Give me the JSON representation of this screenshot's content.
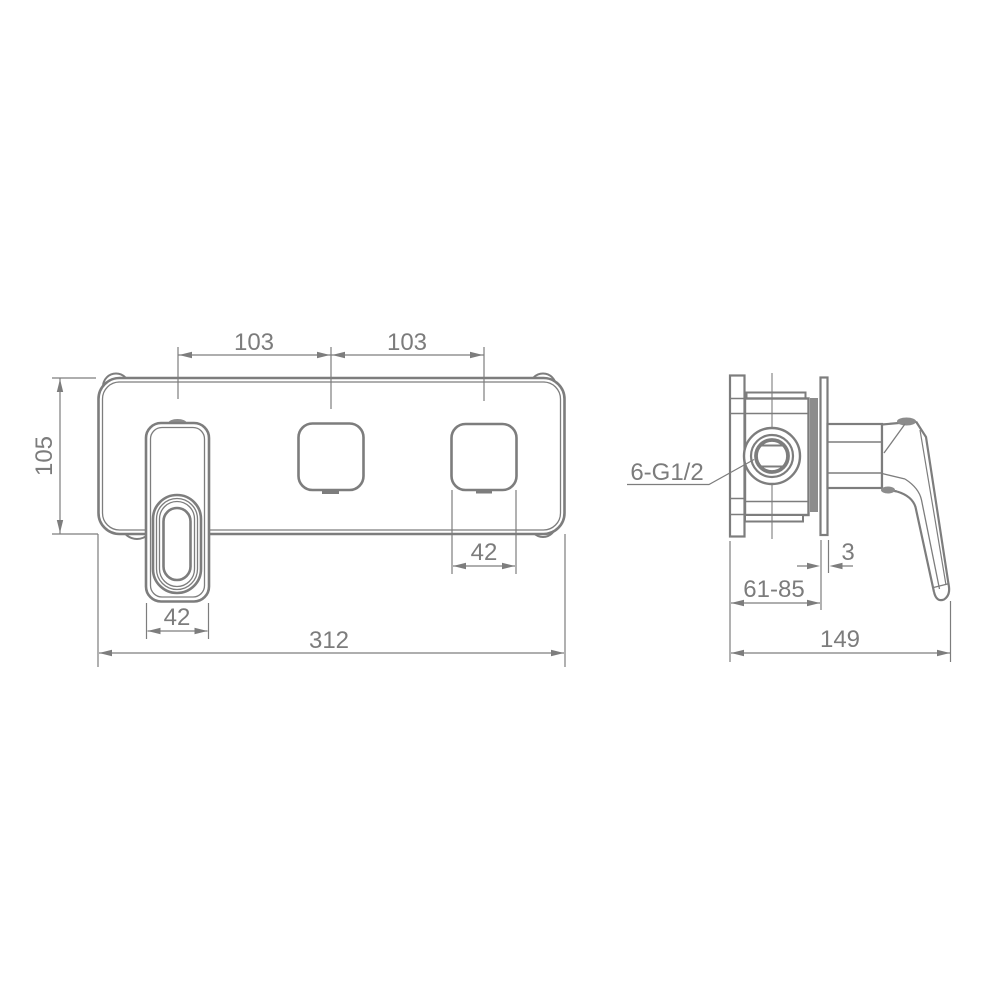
{
  "drawing": {
    "type": "technical-dimension-drawing",
    "subject": "wall-mounted-basin-mixer",
    "colors": {
      "line": "#7d7d7d",
      "text": "#7c7c7c",
      "shade_fill": "#8c8c8c",
      "background": "#ffffff"
    },
    "front_view": {
      "dims": {
        "spacing_left": "103",
        "spacing_right": "103",
        "plate_height": "105",
        "handle_plate_width": "42",
        "outlet_width": "42",
        "plate_width": "312"
      }
    },
    "side_view": {
      "thread_label": "6-G1/2",
      "dims": {
        "wall_plate_thickness": "3",
        "install_depth_range": "61-85",
        "total_depth": "149"
      }
    }
  }
}
